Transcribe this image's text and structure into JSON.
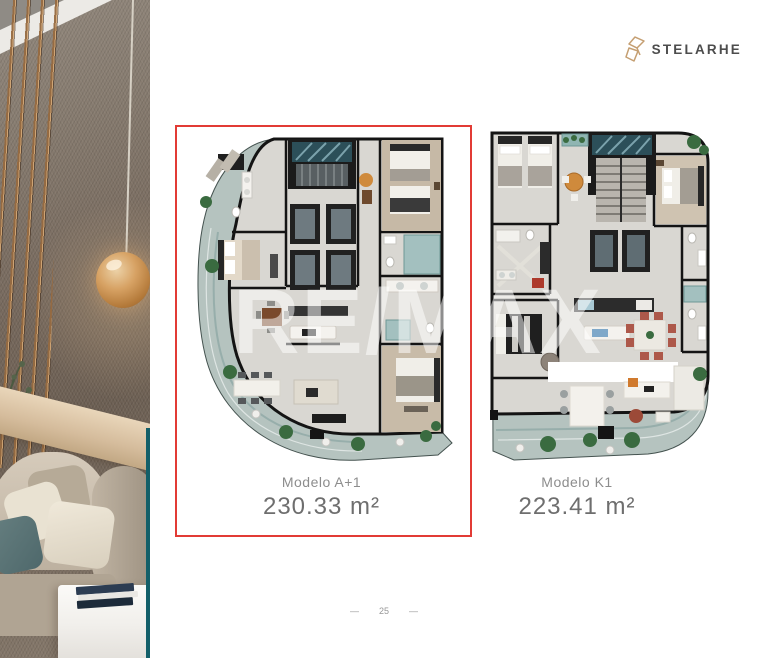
{
  "brand": {
    "name": "STELARHE",
    "accent_gold": "#c59f72",
    "text_color": "#4d4d4d"
  },
  "plans": [
    {
      "model": "Modelo A+1",
      "area": "230.33 m²",
      "highlighted": true
    },
    {
      "model": "Modelo K1",
      "area": "223.41 m²",
      "highlighted": false
    }
  ],
  "watermark": {
    "text": "RE/MAX"
  },
  "footer": {
    "page_number": "25",
    "dash": "—"
  },
  "colors": {
    "highlight_red": "#e23b35",
    "teal_accent": "#135f69",
    "plan_wall": "#141414",
    "plan_floor": "#d9d7d2",
    "plan_balcony": "#b5c3bf",
    "background": "#ffffff"
  }
}
